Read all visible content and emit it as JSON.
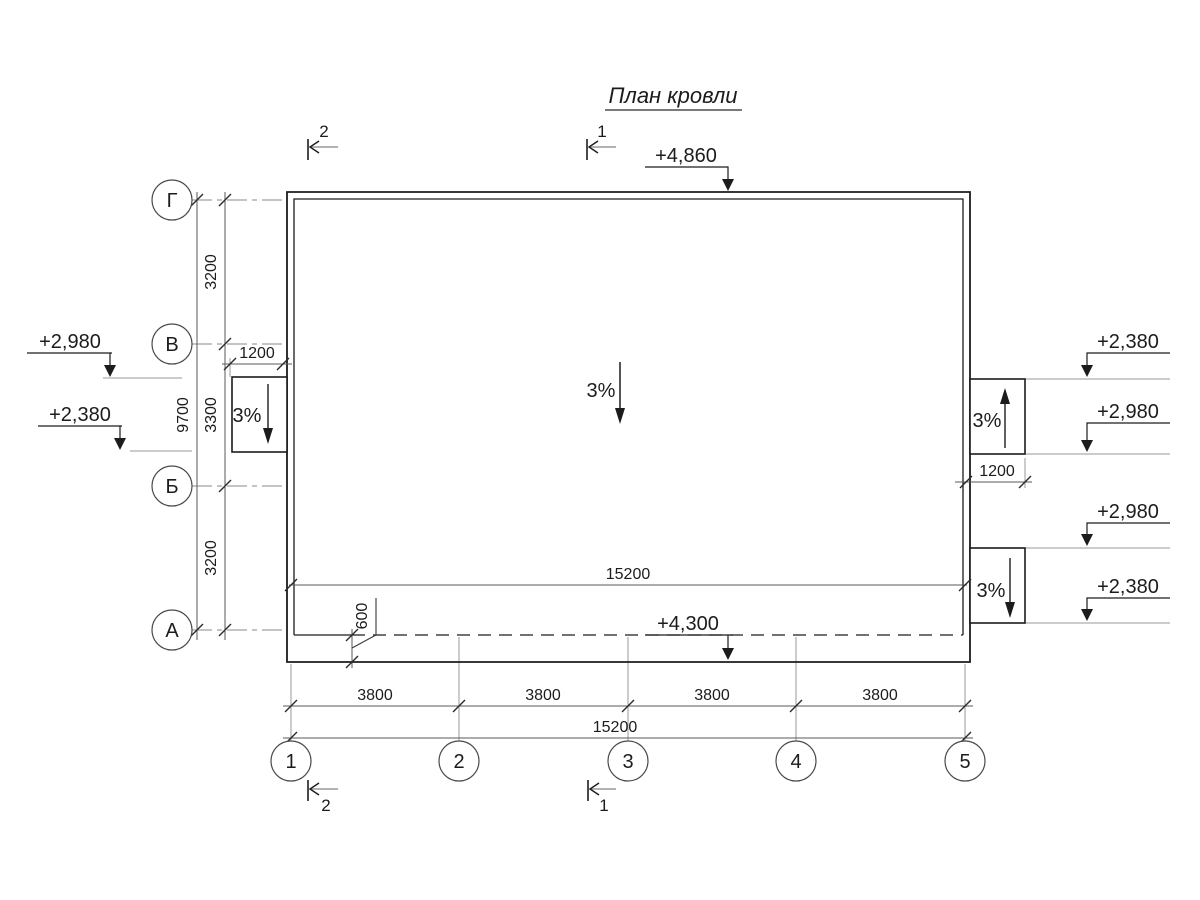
{
  "title": "План кровли",
  "roof": {
    "main_slope": "3%",
    "elevation_top": "+4,860",
    "elevation_eave": "+4,300"
  },
  "canopies": {
    "left": {
      "slope": "3%",
      "width": "1200",
      "top_elevation": "+2,980",
      "bottom_elevation": "+2,380"
    },
    "right_upper": {
      "slope": "3%",
      "width": "1200",
      "top_elevation": "+2,380",
      "bottom_elevation": "+2,980"
    },
    "right_lower": {
      "slope": "3%",
      "top_elevation": "+2,980",
      "bottom_elevation": "+2,380"
    }
  },
  "axes": {
    "rows": [
      "Г",
      "В",
      "Б",
      "А"
    ],
    "columns": [
      "1",
      "2",
      "3",
      "4",
      "5"
    ]
  },
  "dims": {
    "row_spacings": [
      "3200",
      "3300",
      "3200"
    ],
    "rows_total": "9700",
    "col_spacings": [
      "3800",
      "3800",
      "3800",
      "3800"
    ],
    "cols_total": "15200",
    "inner_width": "15200",
    "eave_overhang": "600"
  },
  "sections": {
    "one": "1",
    "two": "2"
  },
  "colors": {
    "line": "#1c1c1c",
    "dim": "#5a5a5a",
    "ext": "#8a8a8a"
  }
}
